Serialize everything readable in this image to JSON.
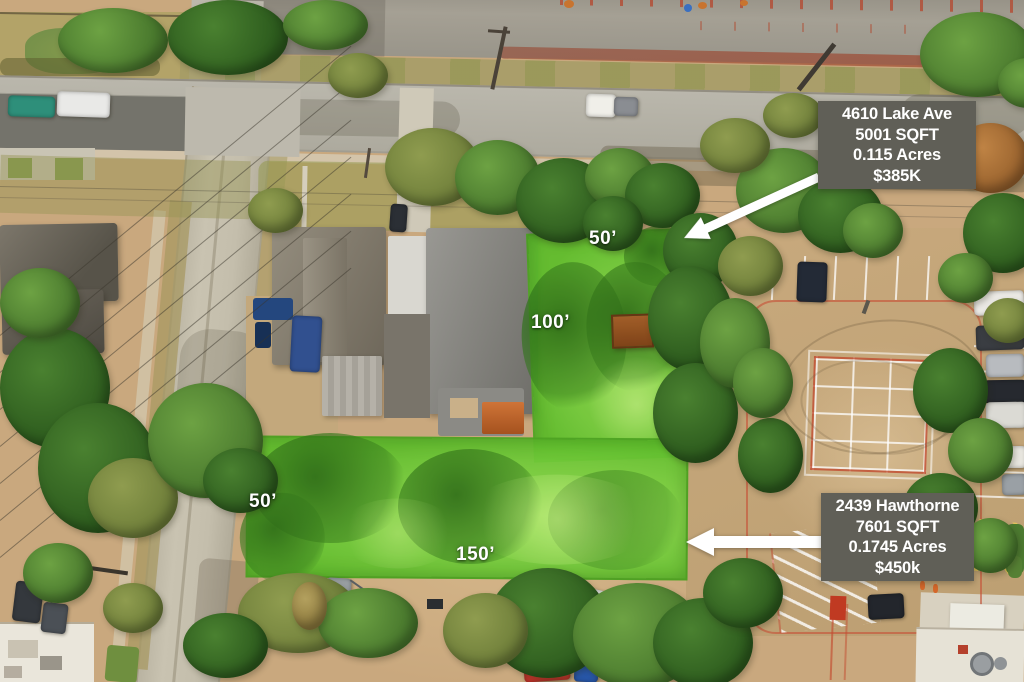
{
  "colors": {
    "overlay_green": "#5fbe2c",
    "lime_light": "#94e054",
    "info_box_bg": "#605f57",
    "label_white": "#ffffff",
    "arrow_white": "#ffffff"
  },
  "lot_lake": {
    "address": "4610 Lake Ave",
    "sqft": "5001 SQFT",
    "acres": "0.115 Acres",
    "price": "$385K",
    "width_label": "50’",
    "depth_label": "100’"
  },
  "lot_hawthorne": {
    "address": "2439 Hawthorne",
    "sqft": "7601 SQFT",
    "acres": "0.1745 Acres",
    "price": "$450k",
    "width_label": "150’",
    "depth_label": "50’"
  }
}
